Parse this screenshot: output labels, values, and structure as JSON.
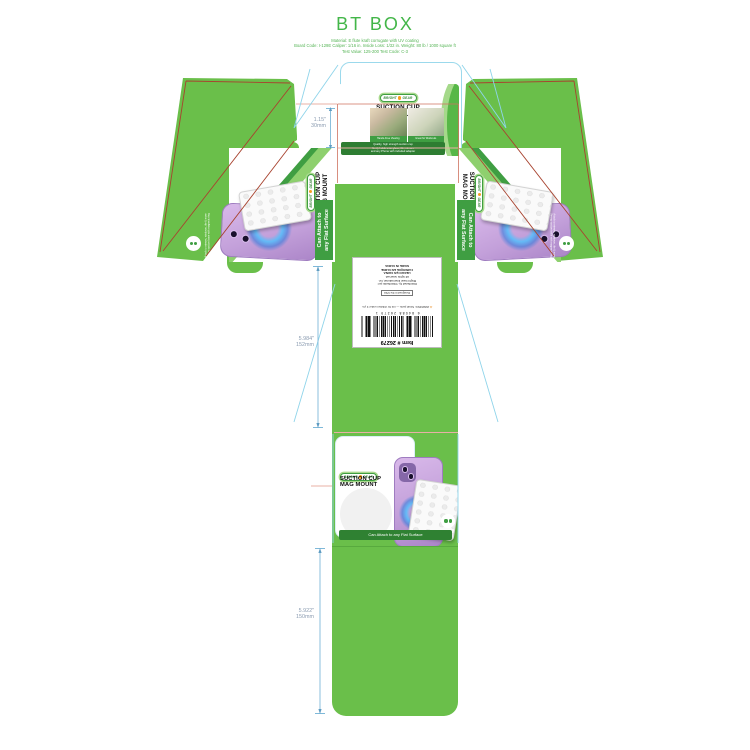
{
  "header": {
    "title": "BT BOX",
    "specs": [
      "Material: E flute kraft corrugate with UV coating",
      "Board Code: I-129E   Caliper: 1/16 in.   Inside Loss: 1/32 in.   Weight: 80 lb / 1000 square ft",
      "Test Value: 125-200   Test Code: C-3"
    ]
  },
  "brand": {
    "logo_a": "BRIGHT",
    "logo_b": "GEAR",
    "t1": "SUCTION CUP",
    "t2": "MAG MOUNT",
    "caption_left": "Hands-Free Viewing",
    "caption_right": "Great for Workouts",
    "info": [
      "Quality, high strength suction cup",
      "firmly holds onto glass, tile, mirrors",
      "and any Phone with included adapter"
    ],
    "slogan_l1": "Can Attach to",
    "slogan_l2": "any Flat Surface",
    "slogan": "Can Attach to any Flat Surface",
    "note1": "Attach to mirrors, windows, tile & more",
    "note2": "Strong suction base with magnetic ring"
  },
  "label": {
    "item": "Item # 26279",
    "barcode_digits": "6 84088 26279 1",
    "warning": "WARNING: Small parts — not for children under 3 yrs.",
    "warning_icon": "⚠",
    "boxed": "Designed in the USA",
    "lines": [
      "Distributed by / Distribuido por:",
      "Bright Gear International, Inc.",
      "All rights reserved.",
      "HECHO EN CHINA",
      "FABRIQUÉ EN CHINE",
      "MADE IN CHINA"
    ]
  },
  "dimensions": {
    "top": {
      "inches": "1.15\"",
      "mm": "30mm"
    },
    "middle": {
      "inches": "5.984\"",
      "mm": "152mm"
    },
    "bottom": {
      "inches": "5.922\"",
      "mm": "150mm"
    }
  },
  "colors": {
    "box_green": "#6abf4a",
    "accent_green": "#3f9e42",
    "dark_green": "#2e7d32",
    "dieline_red": "#a8432f",
    "crease_pink": "#e8b0a6",
    "cut_cyan": "#8fd4ea",
    "dim_text": "#8a9bb0",
    "logo_orange": "#f59e20",
    "phone_lavender": "#c7a3dd",
    "glow_blue": "#3aa0e8",
    "title_green": "#43b649"
  }
}
